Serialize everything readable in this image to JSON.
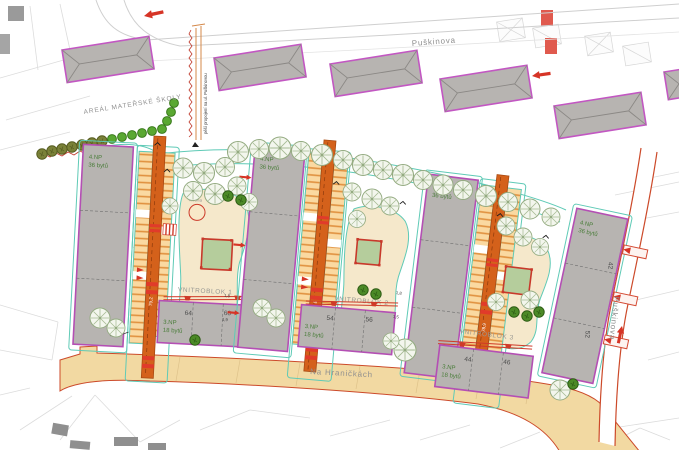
{
  "streets": {
    "top": "Puškinova",
    "right": "Puškinova",
    "bottom": "Na Hraničkách"
  },
  "areas": {
    "kindergarten": "AREÁL MATEŘSKÉ ŠKOLY",
    "pedestrian_link": "pěší propojení na ul. Puškinovou",
    "well": "studna"
  },
  "courtyards": [
    {
      "name": "VNITROBLOK 1"
    },
    {
      "name": "VNITROBLOK 2"
    },
    {
      "name": "VNITROBLOK 3"
    }
  ],
  "buildings": {
    "tall": [
      {
        "floors": "4.NP",
        "units": "36 bytů"
      },
      {
        "floors": "4.NP",
        "units": "36 bytů"
      },
      {
        "floors": "4.NP",
        "units": "36 bytů"
      },
      {
        "floors": "4.NP",
        "units": "36 bytů",
        "numbers": [
          "42",
          "52"
        ]
      }
    ],
    "low": [
      {
        "floors": "3.NP",
        "units": "18 bytů",
        "numbers": [
          "64",
          "66"
        ]
      },
      {
        "floors": "3.NP",
        "units": "18 bytů",
        "numbers": [
          "54",
          "56"
        ]
      },
      {
        "floors": "3.NP",
        "units": "18 bytů",
        "numbers": [
          "44",
          "46"
        ]
      }
    ]
  },
  "road_marks": [
    "79,2",
    "77,8",
    "78,9"
  ],
  "entrance_marks": [
    "1,9",
    "1,8",
    "1,5"
  ],
  "colors": {
    "building_fill": "#b7b4b1",
    "building_outline": "#b44fb4",
    "road_orange": "#d4611b",
    "parking_fill": "#fad9a1",
    "parking_stripe": "#e0913f",
    "path_teal": "#5fcab6",
    "lawn_beige": "#f5e8cb",
    "playground_green": "#b5cd9c",
    "marker_red": "#d63426",
    "street_beige": "#f2d9a2",
    "street_edge_red": "#cc4a2a",
    "label_gray": "#8f8f8f",
    "label_green": "#4a7d3a"
  }
}
